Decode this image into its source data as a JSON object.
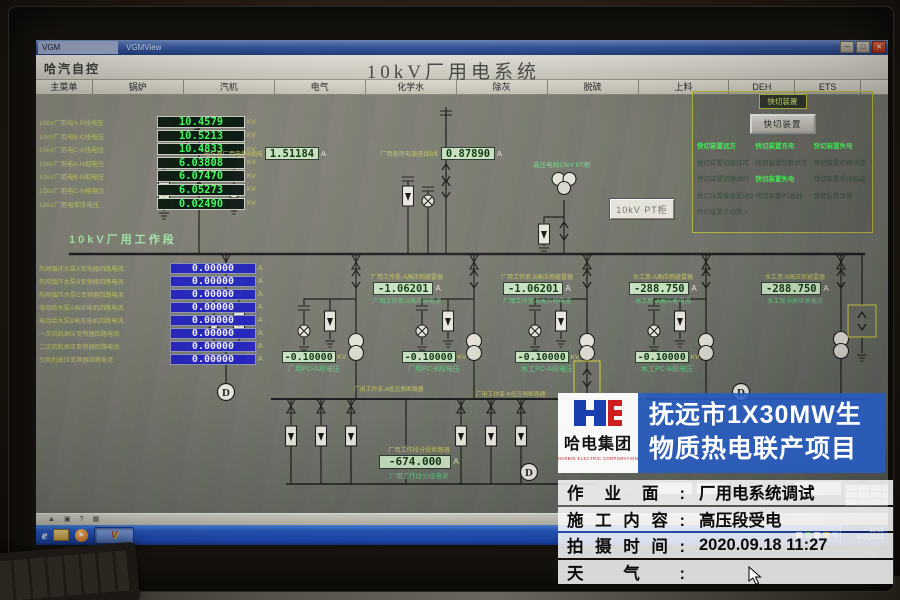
{
  "window": {
    "tab": "VGM",
    "app": "VGMView",
    "min": "─",
    "max": "□",
    "close": "✕"
  },
  "header": {
    "brand": "哈汽自控",
    "title": "10kV厂用电系统"
  },
  "menu": {
    "items": [
      "主菜单",
      "锅炉",
      "汽机",
      "电气",
      "化学水",
      "除灰",
      "脱硫",
      "上料",
      "DEH",
      "ETS"
    ]
  },
  "hv": {
    "rows": [
      {
        "label": "10kV厂用电A-B线电压",
        "value": "10.4579",
        "unit": "KV"
      },
      {
        "label": "10kV厂用电B-C线电压",
        "value": "10.5213",
        "unit": "KV"
      },
      {
        "label": "10kV厂用电C-A线电压",
        "value": "10.4833",
        "unit": "KV"
      },
      {
        "label": "10kV厂用电A-N相电压",
        "value": "6.03808",
        "unit": "KV"
      },
      {
        "label": "10kV厂用电B-N相电压",
        "value": "6.07470",
        "unit": "KV"
      },
      {
        "label": "10kV厂用电C-N相电压",
        "value": "6.05273",
        "unit": "KV"
      },
      {
        "label": "10kV厂用电零序电压",
        "value": "0.02490",
        "unit": "KV"
      }
    ]
  },
  "feeders": {
    "rows": [
      {
        "label": "热网循环水泵A变频器回路电流",
        "value": "0.00000",
        "unit": "A"
      },
      {
        "label": "热网循环水泵B变频器回路电流",
        "value": "0.00000",
        "unit": "A"
      },
      {
        "label": "热网循环水泵C变频器回路电流",
        "value": "0.00000",
        "unit": "A"
      },
      {
        "label": "电动给水泵A高压电机回路电流",
        "value": "0.00000",
        "unit": "A"
      },
      {
        "label": "电动给水泵B高压电机回路电流",
        "value": "0.00000",
        "unit": "A"
      },
      {
        "label": "一次风机高压变频器回路电流",
        "value": "0.00000",
        "unit": "A"
      },
      {
        "label": "二次风机高压变频器回路电流",
        "value": "0.00000",
        "unit": "A"
      },
      {
        "label": "引风机高压变频器回路电流",
        "value": "0.00000",
        "unit": "A"
      }
    ]
  },
  "diagram": {
    "work_bus_label": "10kV厂用工作段",
    "pt_area_label": "高压电网10kV PT柜",
    "pt_box_label": "10kV PT柜",
    "incomers": [
      {
        "label": "电抗器厂用电侧B相电流",
        "value": "1.51184",
        "unit": "A"
      },
      {
        "label": "厂用备用电源进线B相电流",
        "value": "0.87890",
        "unit": "A"
      }
    ],
    "transformers": [
      {
        "top": "厂用工作变-A高压侧避雷器",
        "value": "-1.06201",
        "unit": "A",
        "bottom": "厂用工作变-A高压侧电流"
      },
      {
        "top": "厂用工作变-B高压侧避雷器",
        "value": "-1.06201",
        "unit": "A",
        "bottom": "厂用工作变-B高压侧电流"
      },
      {
        "top": "水工变-A高压侧避雷器",
        "value": "-288.750",
        "unit": "A",
        "bottom": "水工变-A高压侧电流"
      },
      {
        "top": "水工变-B高压侧避雷器",
        "value": "-288.750",
        "unit": "A",
        "bottom": "水工变-B高压侧电流"
      }
    ],
    "pc_buses": [
      {
        "value": "-0.10000",
        "unit": "KV",
        "label": "厂用PC-A段电压"
      },
      {
        "value": "-0.10000",
        "unit": "KV",
        "label": "厂用PC-B段电压"
      },
      {
        "value": "-0.10000",
        "unit": "KV",
        "label": "水工PC-A段电压"
      },
      {
        "value": "-0.10000",
        "unit": "KV",
        "label": "水工PC-B段电压"
      }
    ],
    "lv_breaker_labels": [
      "厂用工作变-A低压侧断路器",
      "厂用工作变-B低压侧断路器",
      "水工变-A低压侧断路器"
    ],
    "tie": {
      "top": "厂用工作段分段断路器",
      "value": "-674.000",
      "unit": "A",
      "bottom": "厂用工作段分段电流"
    }
  },
  "fast_switch": {
    "title": "快切装置",
    "button": "快切装置",
    "col1": [
      {
        "text": "快切装置远方",
        "active": true
      },
      {
        "text": "快切装置切换许可",
        "active": false
      },
      {
        "text": "快切装置切换进行",
        "active": false
      },
      {
        "text": "快切装置备自投闭锁",
        "active": false
      },
      {
        "text": "快切装置手动投入",
        "active": false
      }
    ],
    "col2": [
      {
        "text": "快切装置充电",
        "active": true
      },
      {
        "text": "快切装置切换异常",
        "active": false
      },
      {
        "text": "快切装置失电",
        "active": true
      },
      {
        "text": "快切装置PT断线",
        "active": false
      }
    ],
    "col3": [
      {
        "text": "快切装置失电",
        "active": true
      },
      {
        "text": "快切装置切换闭锁",
        "active": false
      },
      {
        "text": "快切装置手动启动",
        "active": false
      },
      {
        "text": "快切装置异常",
        "active": false
      }
    ]
  },
  "taskbar": {
    "time": "11:22",
    "date": "2020/9/18"
  },
  "watermark": {
    "company": "哈电集团",
    "company_en": "HARBIN ELECTRIC CORPORATION",
    "project_line1": "抚远市1X30MW生",
    "project_line2": "物质热电联产项目",
    "info": [
      {
        "label": "作业面:",
        "value": "厂用电系统调试"
      },
      {
        "label": "施工内容:",
        "value": "高压段受电"
      },
      {
        "label": "拍摄时间:",
        "value": "2020.09.18 11:27"
      },
      {
        "label": "天气:",
        "value": ""
      }
    ]
  },
  "colors": {
    "display_green": "#42ff5e",
    "display_blue_bg": "#2523bd",
    "pale_green_bg": "#cde6c3",
    "panel_yellow": "#b8bc3a",
    "taskbar_blue": "#2a5cc8",
    "watermark_blue": "#255cc4"
  }
}
